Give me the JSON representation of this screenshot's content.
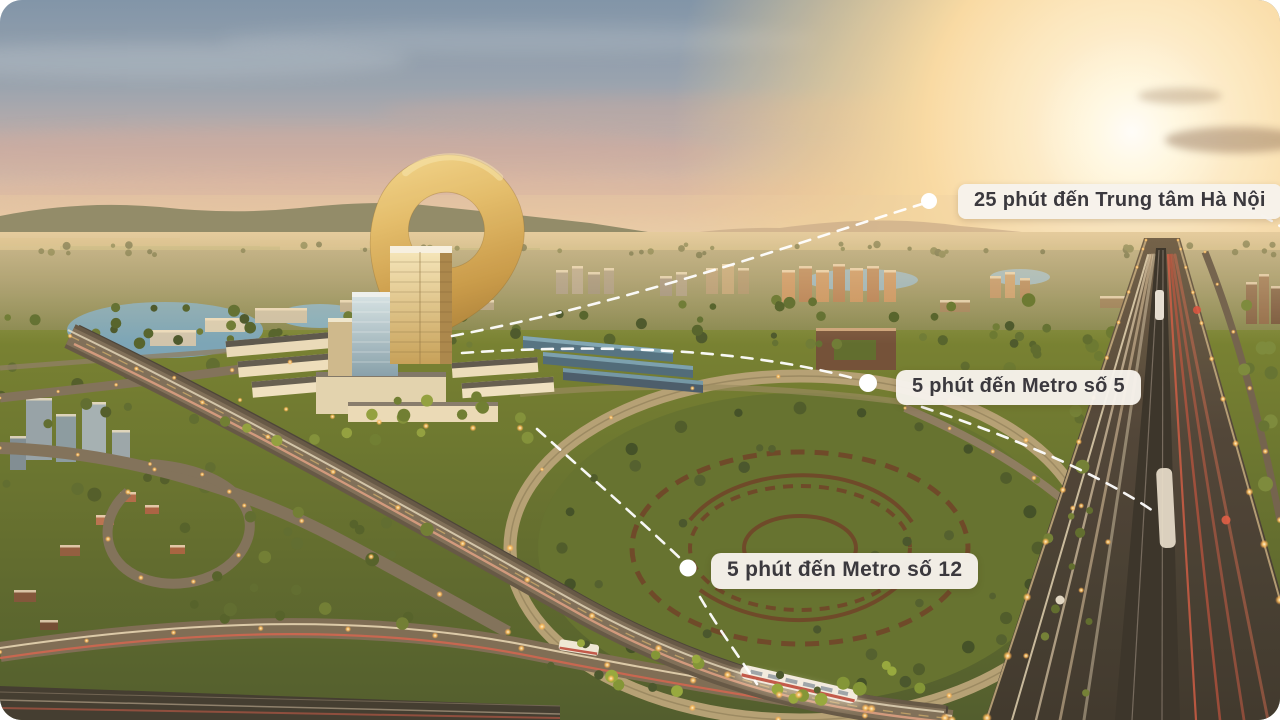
{
  "callouts": [
    {
      "id": "hanoi",
      "label": "25 phút đến Trung tâm Hà Nội"
    },
    {
      "id": "metro5",
      "label": "5 phút đến Metro số 5"
    },
    {
      "id": "metro12",
      "label": "5 phút đến Metro số 12"
    }
  ],
  "icons": {
    "pin": "golden-location-pin",
    "route_marker": "white-route-dot"
  },
  "colors": {
    "pill_bg": "#f7f3ec",
    "pill_text": "#3b393e",
    "gold": "#d9b261",
    "route_dash": "#ffffff"
  }
}
